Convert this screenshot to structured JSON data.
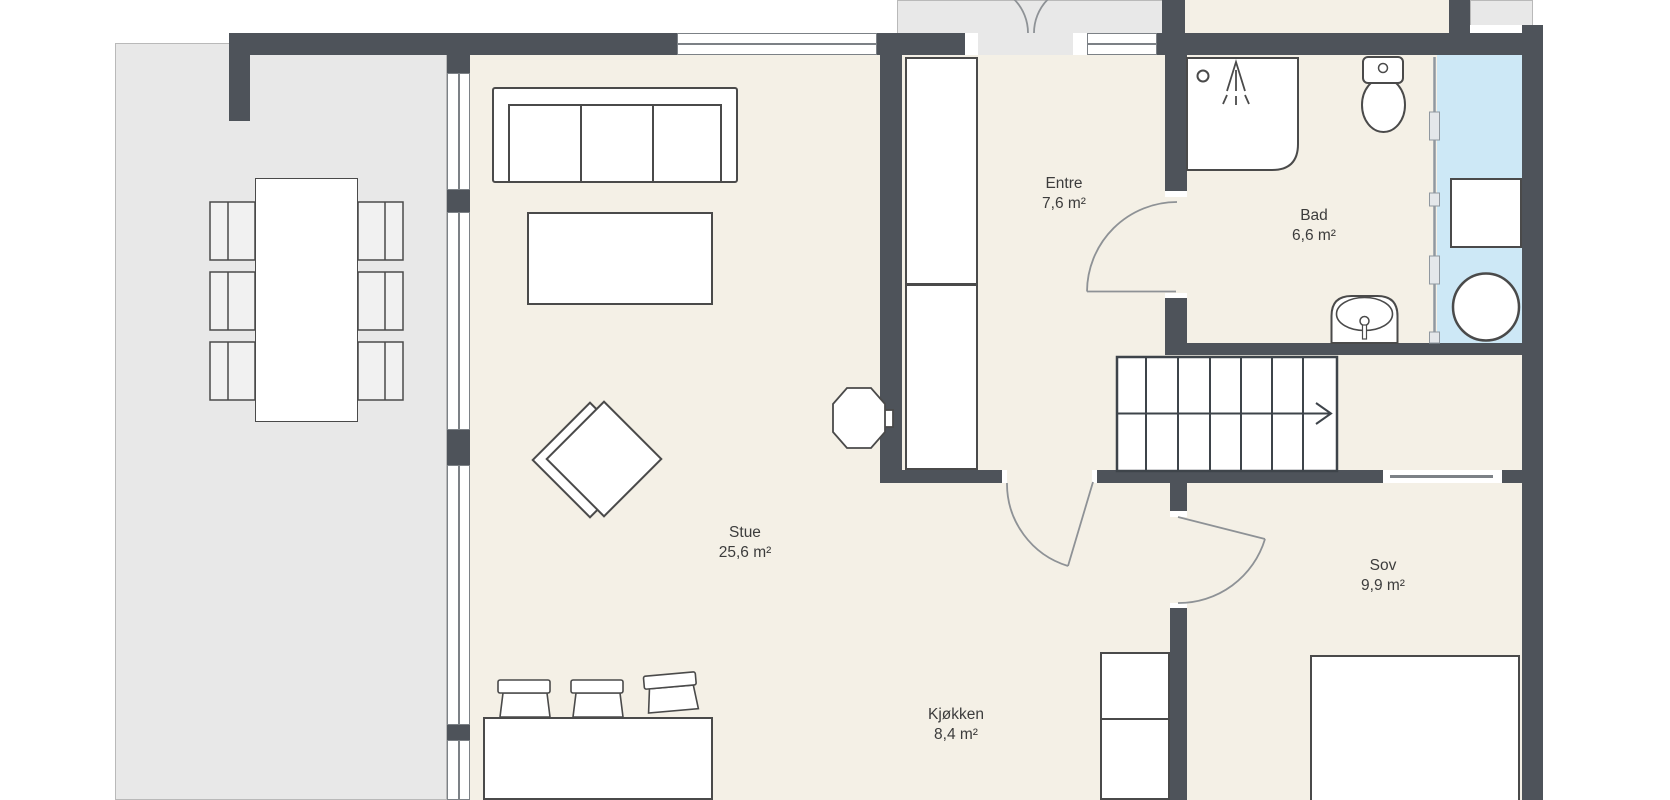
{
  "rooms": [
    {
      "id": "stue",
      "name": "Stue",
      "area": "25,6 m²"
    },
    {
      "id": "entre",
      "name": "Entre",
      "area": "7,6 m²"
    },
    {
      "id": "bad",
      "name": "Bad",
      "area": "6,6 m²"
    },
    {
      "id": "sov",
      "name": "Sov",
      "area": "9,9 m²"
    },
    {
      "id": "kjokken",
      "name": "Kjøkken",
      "area": "8,4 m²"
    }
  ],
  "colors": {
    "wall": "#4e535a",
    "floor": "#f4f0e6",
    "terrace": "#e8e8e8",
    "terrace_border": "#b9b9b9",
    "wet_area": "#cde8f6",
    "furniture_outline": "#4a4a4a",
    "door_swing": "#8e9296",
    "window_line": "#7c8186",
    "label_text": "#3c3c3c"
  }
}
